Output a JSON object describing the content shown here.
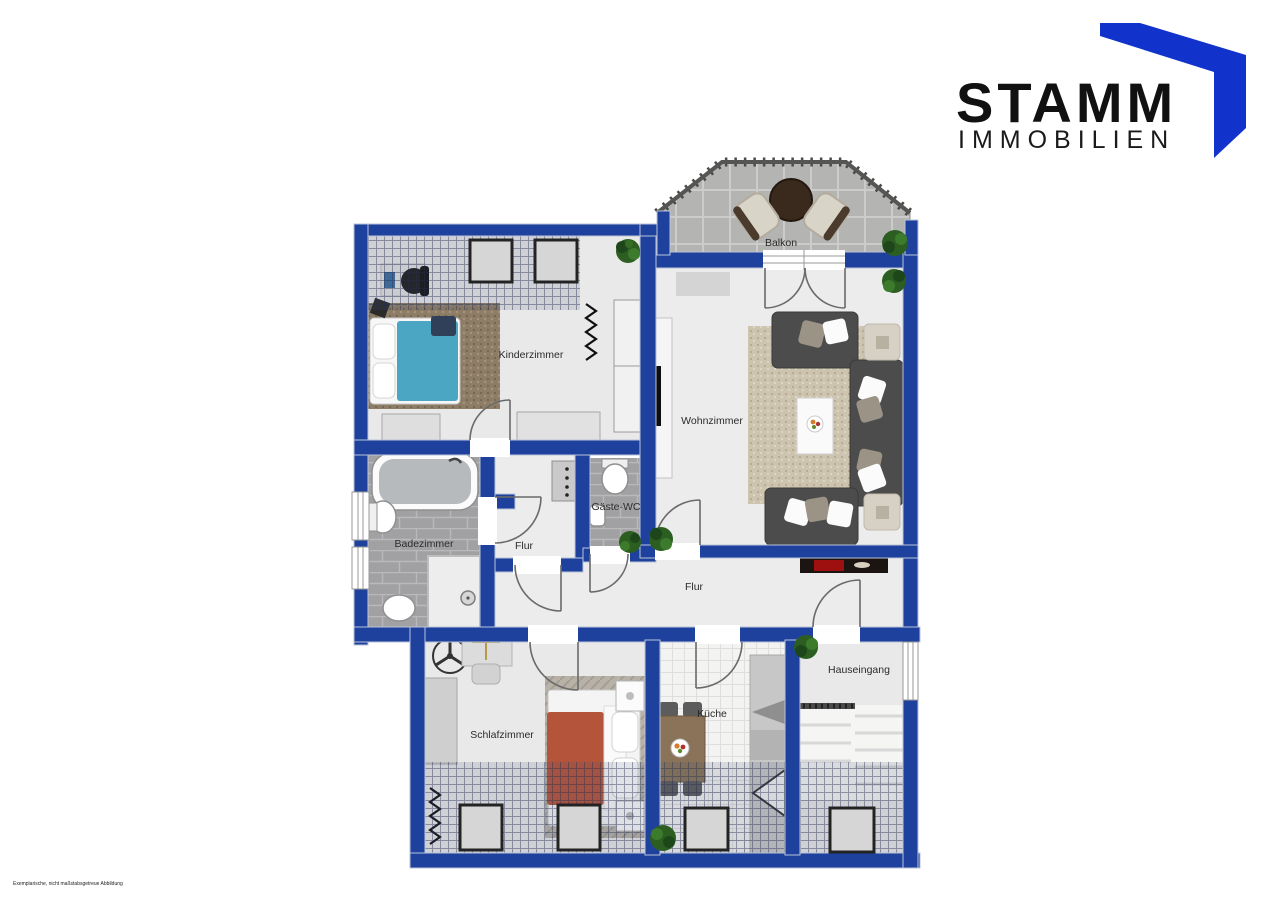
{
  "brand": {
    "name": "STAMM",
    "subtitle": "IMMOBILIEN",
    "logo_blue": "#1133cc",
    "text_color": "#111111"
  },
  "floorplan": {
    "wall_color": "#1e419e",
    "rooms": [
      {
        "label": "Balkon"
      },
      {
        "label": "Kinderzimmer"
      },
      {
        "label": "Wohnzimmer"
      },
      {
        "label": "Badezimmer"
      },
      {
        "label": "Flur"
      },
      {
        "label": "Gäste-WC"
      },
      {
        "label": "Flur"
      },
      {
        "label": "Schlafzimmer"
      },
      {
        "label": "Küche"
      },
      {
        "label": "Hauseingang"
      }
    ],
    "disclaimer": "Exemplarische, nicht maßstabsgetreue Abbildung"
  }
}
